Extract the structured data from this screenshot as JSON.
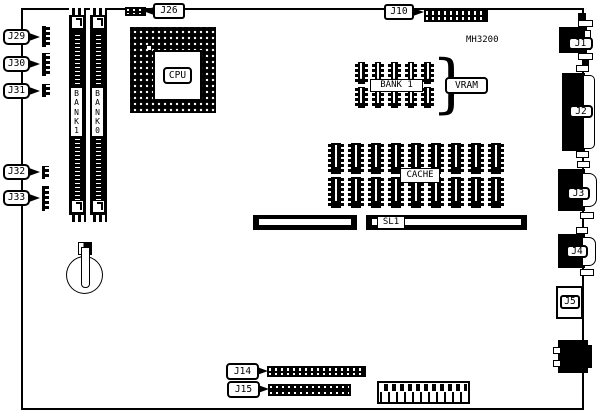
{
  "board": {
    "model": "MH3200"
  },
  "left_callouts": [
    {
      "id": "J29"
    },
    {
      "id": "J30"
    },
    {
      "id": "J31"
    },
    {
      "id": "J32"
    },
    {
      "id": "J33"
    }
  ],
  "top_callouts": [
    {
      "id": "J26"
    },
    {
      "id": "J10"
    }
  ],
  "bottom_callouts": [
    {
      "id": "J14"
    },
    {
      "id": "J15"
    }
  ],
  "right_ports": [
    {
      "id": "J1"
    },
    {
      "id": "J2"
    },
    {
      "id": "J3"
    },
    {
      "id": "J4"
    },
    {
      "id": "J5"
    }
  ],
  "cpu": {
    "label": "CPU"
  },
  "memory_slots": [
    {
      "label": "B\nA\nN\nK\n1"
    },
    {
      "label": "B\nA\nN\nK\n0"
    }
  ],
  "video_memory": {
    "label": "BANK 1",
    "callout": "VRAM",
    "brace": "}",
    "rows": 2,
    "columns": 5
  },
  "cache": {
    "label": "CACHE",
    "rows": 2,
    "columns": 9
  },
  "expansion_slot": {
    "label": "SL1"
  }
}
